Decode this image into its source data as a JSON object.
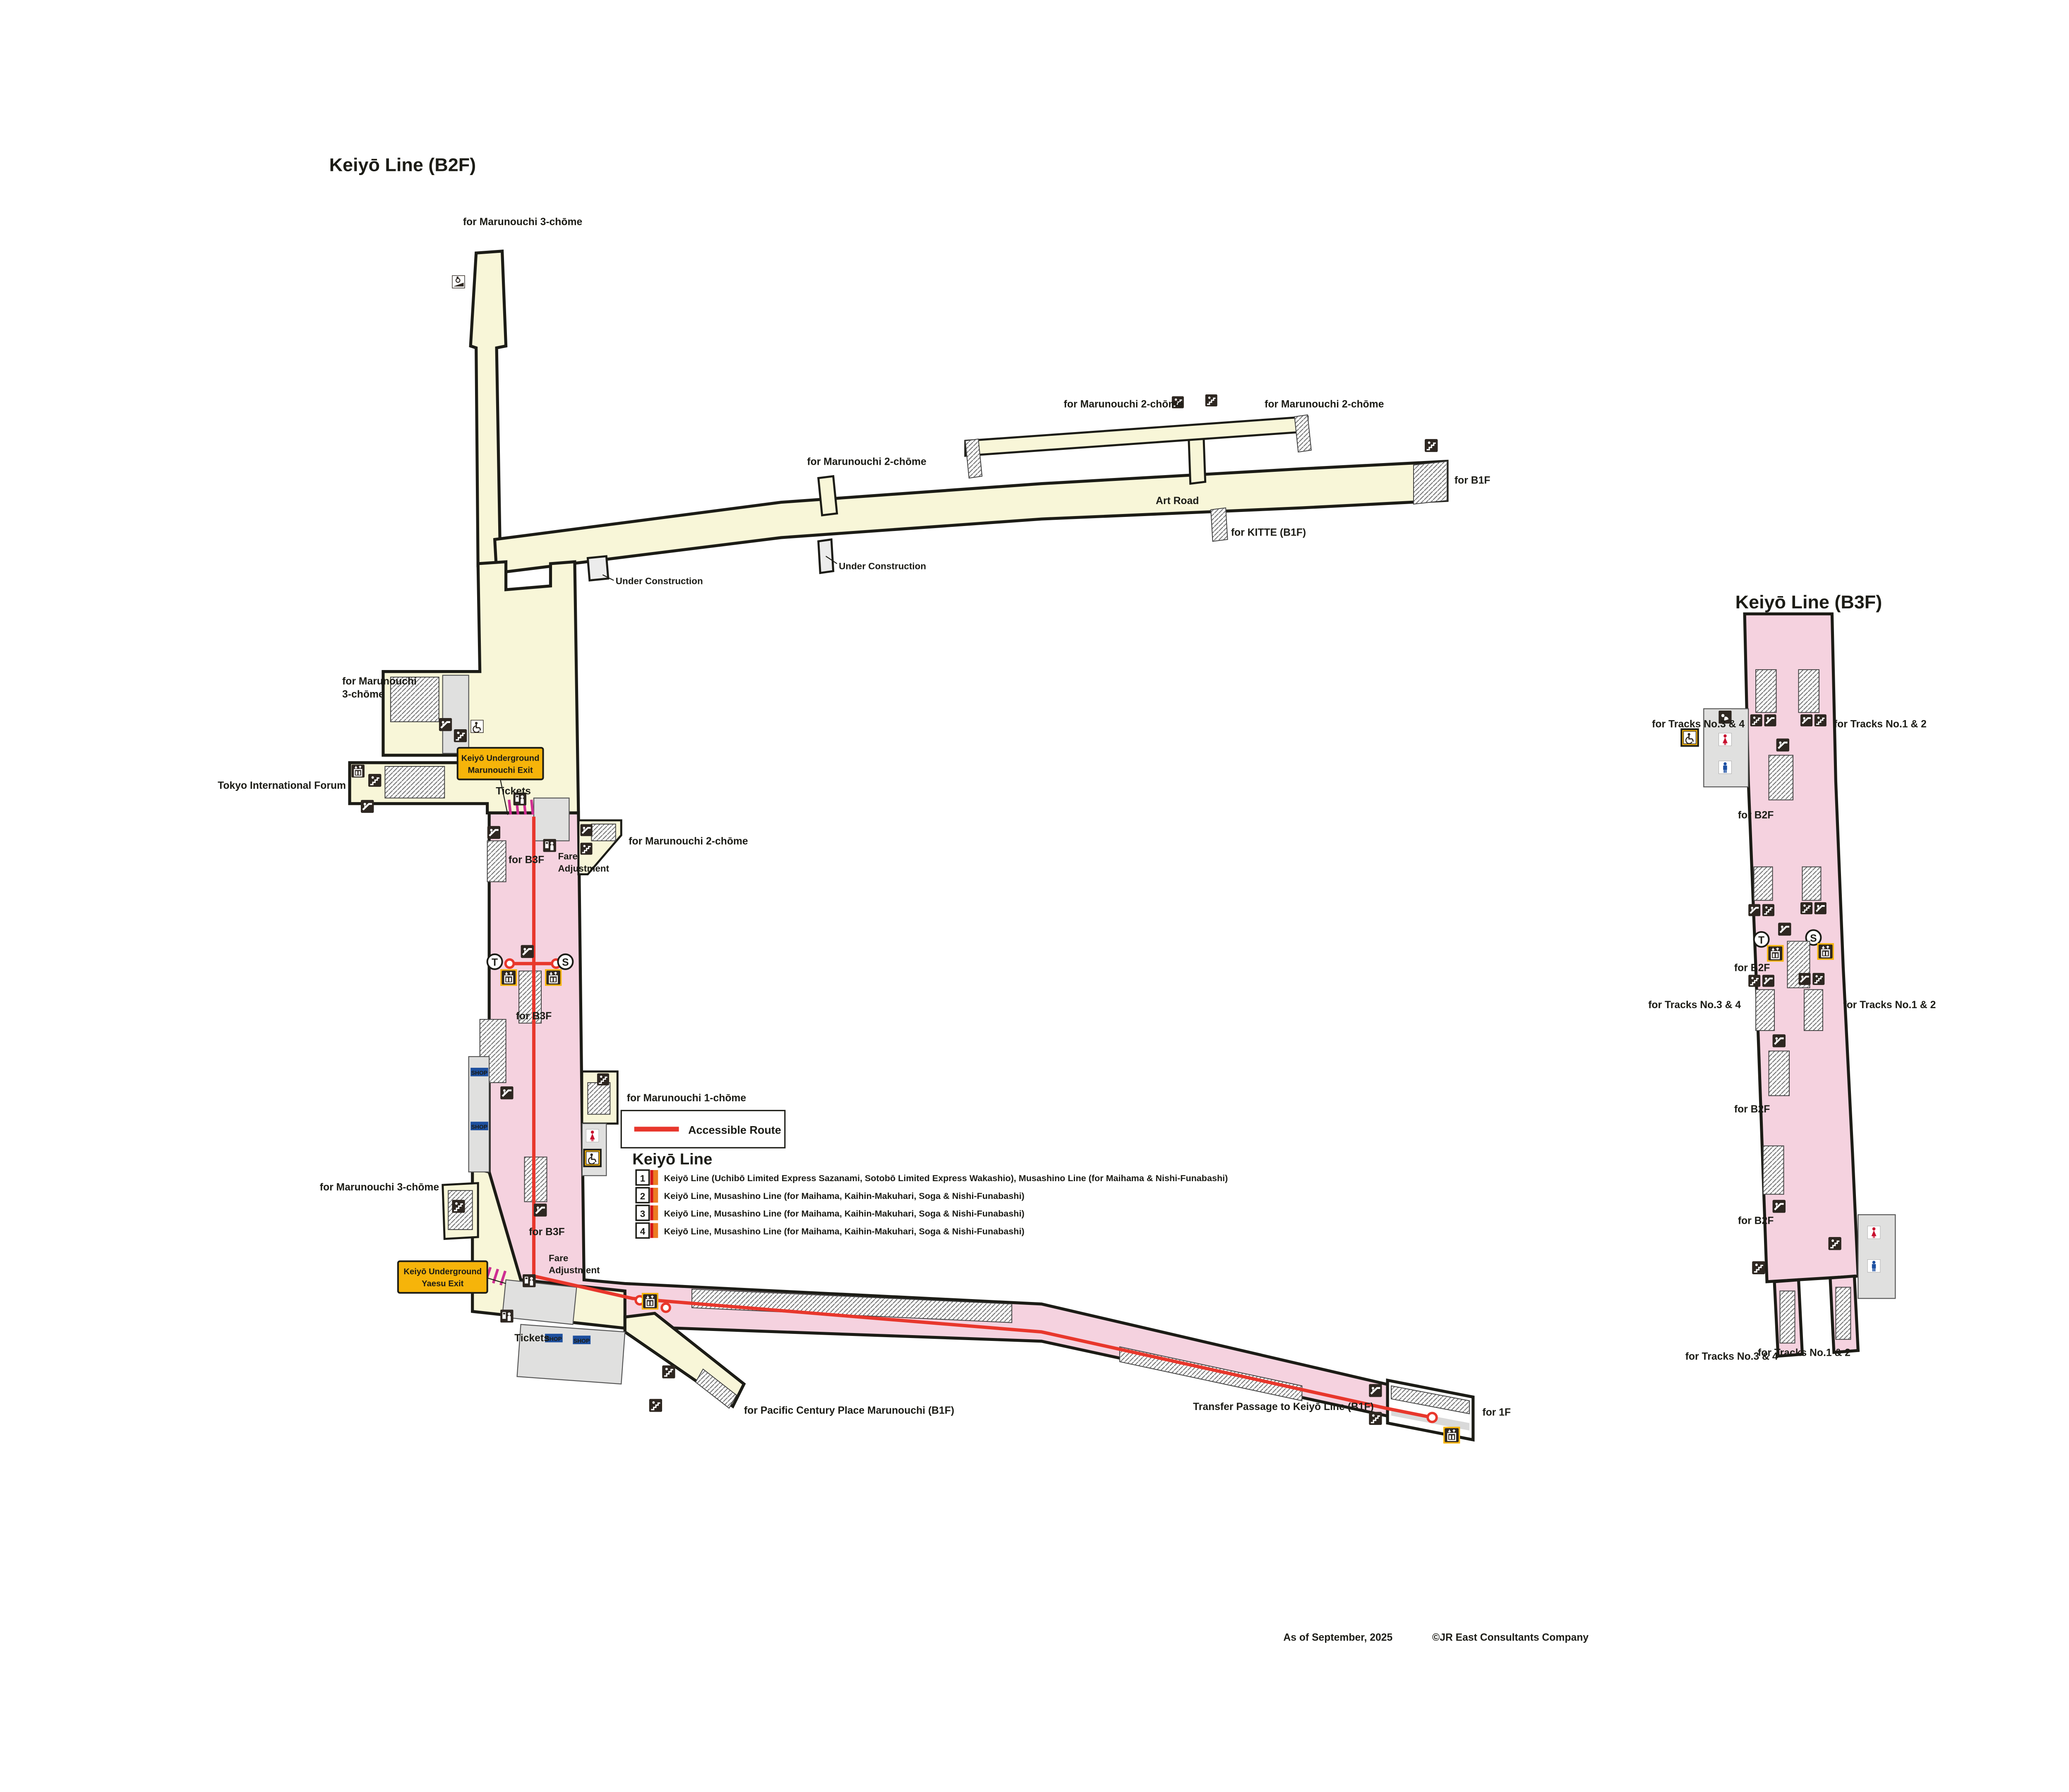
{
  "page": {
    "b2f_title": "Keiyō Line (B2F)",
    "b3f_title": "Keiyō Line (B3F)",
    "b4f_title": "Keiyō Line (B4F)",
    "footer_date": "As of September, 2025",
    "footer_copyright": "©JR East Consultants Company"
  },
  "labels": {
    "marunouchi3": "for Marunouchi 3-chōme",
    "marunouchi3_l1": "for Marunouchi",
    "marunouchi3_l2": "3-chōme",
    "marunouchi2": "for Marunouchi 2-chōme",
    "marunouchi1": "for Marunouchi 1-chōme",
    "art_road": "Art Road",
    "kitte": "for KITTE (B1F)",
    "b1f": "for B1F",
    "under_construction": "Under Construction",
    "tokyo_forum": "Tokyo International Forum",
    "marunouchi_exit_l1": "Keiyō Underground",
    "marunouchi_exit_l2": "Marunouchi Exit",
    "yaesu_exit_l1": "Keiyō Underground",
    "yaesu_exit_l2": "Yaesu Exit",
    "tickets": "Tickets",
    "fare_l1": "Fare",
    "fare_l2": "Adjustment",
    "for_b3f": "for B3F",
    "for_b2f": "for B2F",
    "for_1f": "for 1F",
    "shop": "SHOP",
    "transfer": "Transfer Passage to Keiyō Line (B1F)",
    "pcp": "for Pacific Century Place Marunouchi (B1F)",
    "tracks34": "for Tracks No.3 & 4",
    "tracks12": "for Tracks No.1 & 2",
    "maihama": "for Maihama, Nishi-Funabashi, Kaihin-Makuhari & Soga",
    "newdays_l1": "New",
    "newdays_l2": "Days",
    "elev_t": "T",
    "elev_s": "S"
  },
  "legend": {
    "accessible": "Accessible Route",
    "header": "Keiyō Line",
    "items": [
      {
        "num": "1",
        "desc": "Keiyō Line (Uchibō Limited Express Sazanami, Sotobō Limited Express Wakashio), Musashino Line (for Maihama & Nishi-Funabashi)"
      },
      {
        "num": "2",
        "desc": "Keiyō Line, Musashino Line (for Maihama, Kaihin-Makuhari, Soga & Nishi-Funabashi)"
      },
      {
        "num": "3",
        "desc": "Keiyō Line, Musashino Line (for Maihama, Kaihin-Makuhari, Soga & Nishi-Funabashi)"
      },
      {
        "num": "4",
        "desc": "Keiyō Line, Musashino Line (for Maihama, Kaihin-Makuhari, Soga & Nishi-Funabashi)"
      }
    ]
  },
  "b4f": {
    "tracks": [
      "4",
      "3",
      "2",
      "1"
    ],
    "line_local": "Keiyō Line, Musashino Line (for Maihama, Kaihin-Makuhari, Soga & Nishi-Funabashi)",
    "line_express": "Keiyō Line (Uchibō Limited Express Sazanami, Sotobō Limited Express Wakashio), Musashino Line (for Maihama & Nishi-Funabashi)"
  },
  "colors": {
    "concourse_cream": "#f8f6d8",
    "platform_pink": "#f5d2df",
    "platform_blue": "#b4d8ef",
    "exit_box_yellow": "#f6b40a",
    "accessible_route_red": "#e8372c",
    "track_stripe_red": "#d61518",
    "track_stripe_orange": "#eb7c22",
    "shop_blue": "#1d4f9e",
    "newdays_green": "#7fbe26"
  }
}
